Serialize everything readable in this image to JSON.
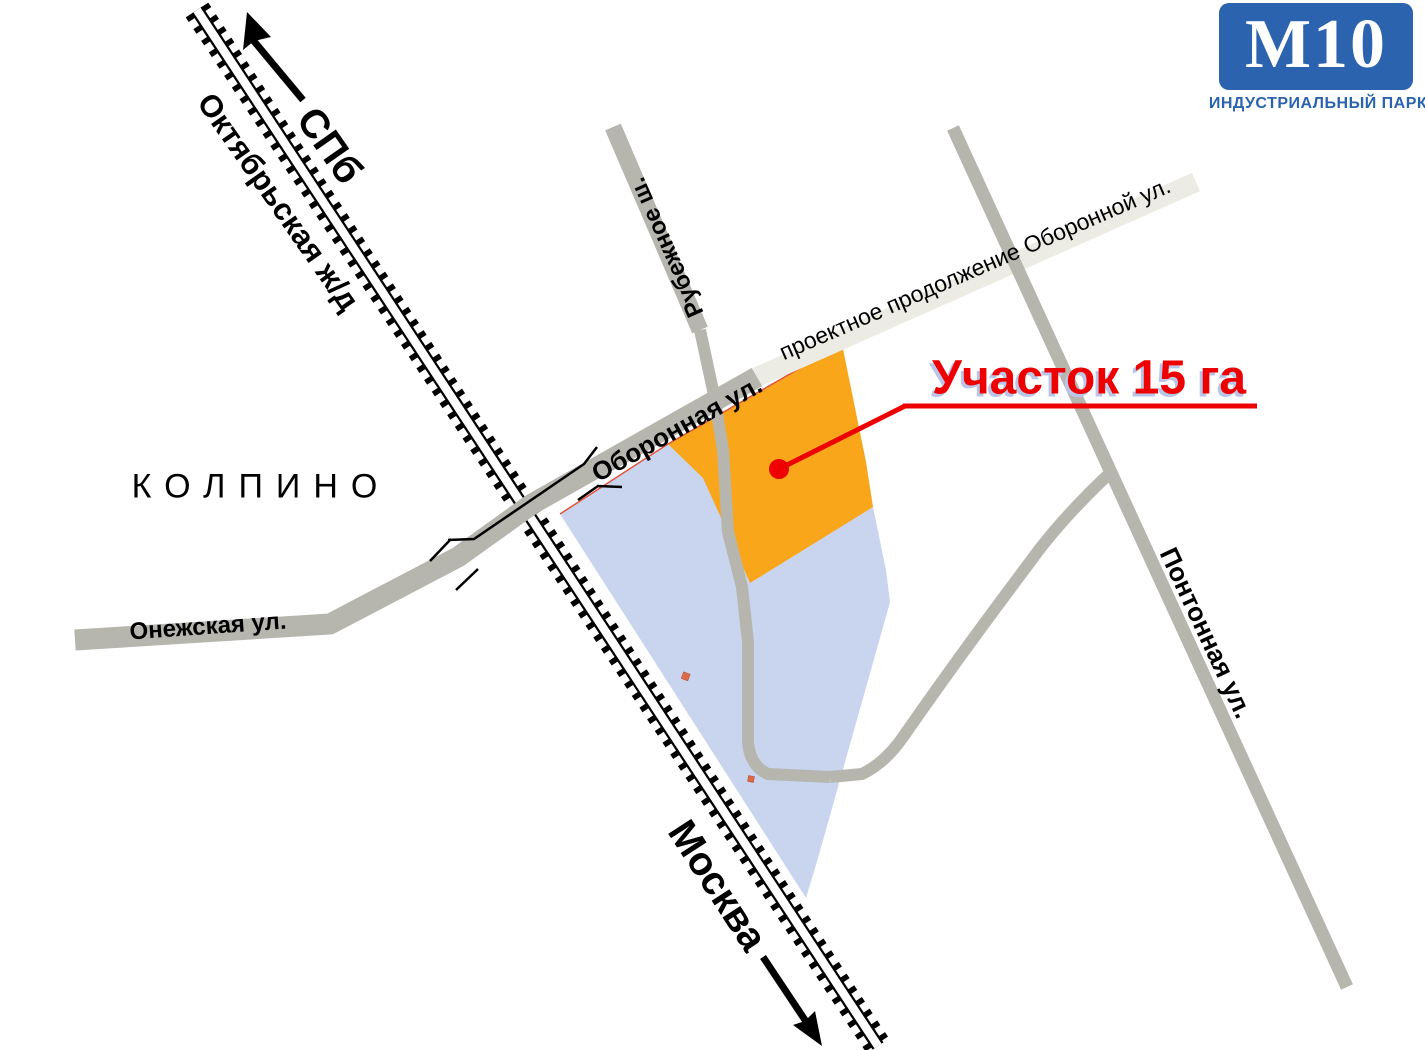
{
  "logo": {
    "title": "М10",
    "subtitle": "ИНДУСТРИАЛЬНЫЙ ПАРК",
    "bg_color": "#2b63ae"
  },
  "map": {
    "city": "КОЛПИНО",
    "railway_name": "Октябрьская ж/д",
    "direction_north": "СПб",
    "direction_south": "Москва",
    "streets": {
      "oboronnaya": "Оборонная ул.",
      "proektnoe": "проектное продолжение  Оборонной ул.",
      "onezhskaya": "Онежская ул.",
      "rubezhnoe": "Рубежное ш.",
      "pontonnaya": "Понтонная ул."
    },
    "plot": {
      "label": "Участок 15 га",
      "plot_color": "#faa61b",
      "zone_color": "#c9d5ee",
      "callout_color": "#ee0000",
      "road_color": "#b6b6ae",
      "projected_road_color": "#ecece4"
    }
  }
}
